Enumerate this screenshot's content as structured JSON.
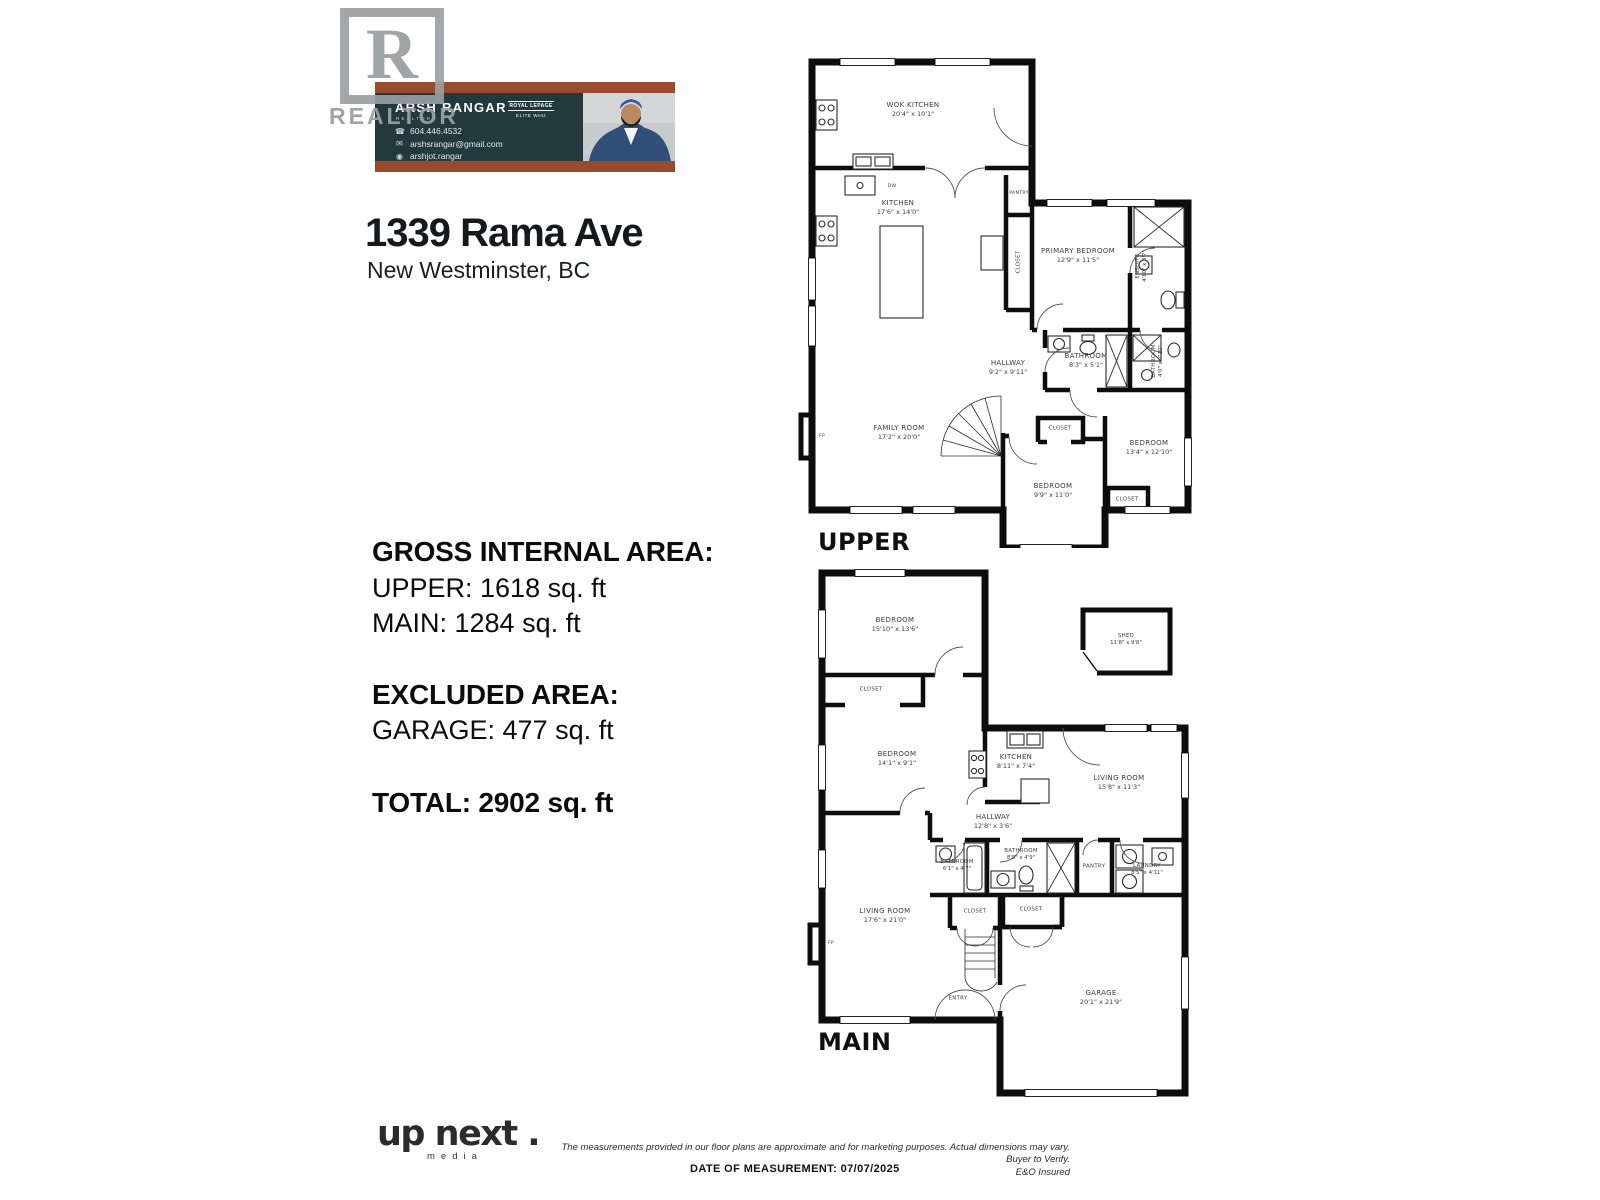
{
  "realtor_logo": {
    "letter": "R",
    "label": "REALTOR"
  },
  "agent_banner": {
    "name": "ARSH RANGAR",
    "subtitle": "REALTOR®",
    "brokerage_line1": "ROYAL LEPAGE",
    "brokerage_line2": "ELITE West",
    "colors": {
      "rust": "#9a4a2d",
      "teal": "#223a3e"
    },
    "contacts": [
      {
        "icon": "phone-icon",
        "text": "604.446.4532"
      },
      {
        "icon": "mail-icon",
        "text": "arshsrangar@gmail.com"
      },
      {
        "icon": "instagram-icon",
        "text": "arshjot.rangar"
      }
    ]
  },
  "address": {
    "line1": "1339 Rama Ave",
    "line2": "New Westminster, BC"
  },
  "areas": {
    "gross_title": "GROSS INTERNAL AREA:",
    "gross_lines": [
      "UPPER: 1618 sq. ft",
      "MAIN: 1284 sq. ft"
    ],
    "excluded_title": "EXCLUDED AREA:",
    "excluded_lines": [
      "GARAGE: 477 sq. ft"
    ],
    "total": "TOTAL: 2902 sq. ft"
  },
  "upper_plan": {
    "floor_label": "UPPER",
    "rooms": [
      {
        "name": "WOK KITCHEN",
        "dims": "20'4\" x 10'1\""
      },
      {
        "name": "KITCHEN",
        "dims": "17'6\" x 14'0\""
      },
      {
        "name": "PANTRY",
        "dims": ""
      },
      {
        "name": "CLOSET",
        "dims": ""
      },
      {
        "name": "PRIMARY BEDROOM",
        "dims": "12'9\" x 11'5\""
      },
      {
        "name": "ENSUITE",
        "dims": "4'10\" x 8'7\""
      },
      {
        "name": "BATHROOM",
        "dims": "8'3\" x 5'1\""
      },
      {
        "name": "BATHROOM",
        "dims": "4'0\" x 7'10\""
      },
      {
        "name": "HALLWAY",
        "dims": "9'2\" x 9'11\""
      },
      {
        "name": "FAMILY ROOM",
        "dims": "17'2\" x 20'0\""
      },
      {
        "name": "CLOSET",
        "dims": ""
      },
      {
        "name": "BEDROOM",
        "dims": "9'9\" x 11'0\""
      },
      {
        "name": "BEDROOM",
        "dims": "13'4\" x 12'10\""
      },
      {
        "name": "CLOSET",
        "dims": ""
      },
      {
        "name": "FP",
        "dims": ""
      },
      {
        "name": "DW",
        "dims": ""
      }
    ]
  },
  "main_plan": {
    "floor_label": "MAIN",
    "rooms": [
      {
        "name": "BEDROOM",
        "dims": "15'10\" x 13'6\""
      },
      {
        "name": "CLOSET",
        "dims": ""
      },
      {
        "name": "BEDROOM",
        "dims": "14'1\" x 9'1\""
      },
      {
        "name": "SHED",
        "dims": "11'8\" x 9'8\""
      },
      {
        "name": "KITCHEN",
        "dims": "8'11\" x 7'4\""
      },
      {
        "name": "LIVING ROOM",
        "dims": "15'8\" x 11'3\""
      },
      {
        "name": "HALLWAY",
        "dims": "12'8\" x 3'6\""
      },
      {
        "name": "BATHROOM",
        "dims": "6'1\" x 4'7\""
      },
      {
        "name": "BATHROOM",
        "dims": "8'9\" x 4'9\""
      },
      {
        "name": "PANTRY",
        "dims": ""
      },
      {
        "name": "LAUNDRY",
        "dims": "8'5\" x 4'11\""
      },
      {
        "name": "CLOSET",
        "dims": ""
      },
      {
        "name": "CLOSET",
        "dims": ""
      },
      {
        "name": "LIVING ROOM",
        "dims": "17'6\" x 21'0\""
      },
      {
        "name": "ENTRY",
        "dims": ""
      },
      {
        "name": "GARAGE",
        "dims": "20'1\" x 21'9\""
      },
      {
        "name": "FP",
        "dims": ""
      }
    ]
  },
  "footer": {
    "logo_main": "up next .",
    "logo_sub": "media",
    "disclaimer_line1": "The measurements provided in our floor plans are approximate and for marketing purposes. Actual dimensions may vary. Buyer to Verify.",
    "disclaimer_line2": "E&O Insured",
    "date_line": "DATE OF MEASUREMENT: 07/07/2025"
  }
}
